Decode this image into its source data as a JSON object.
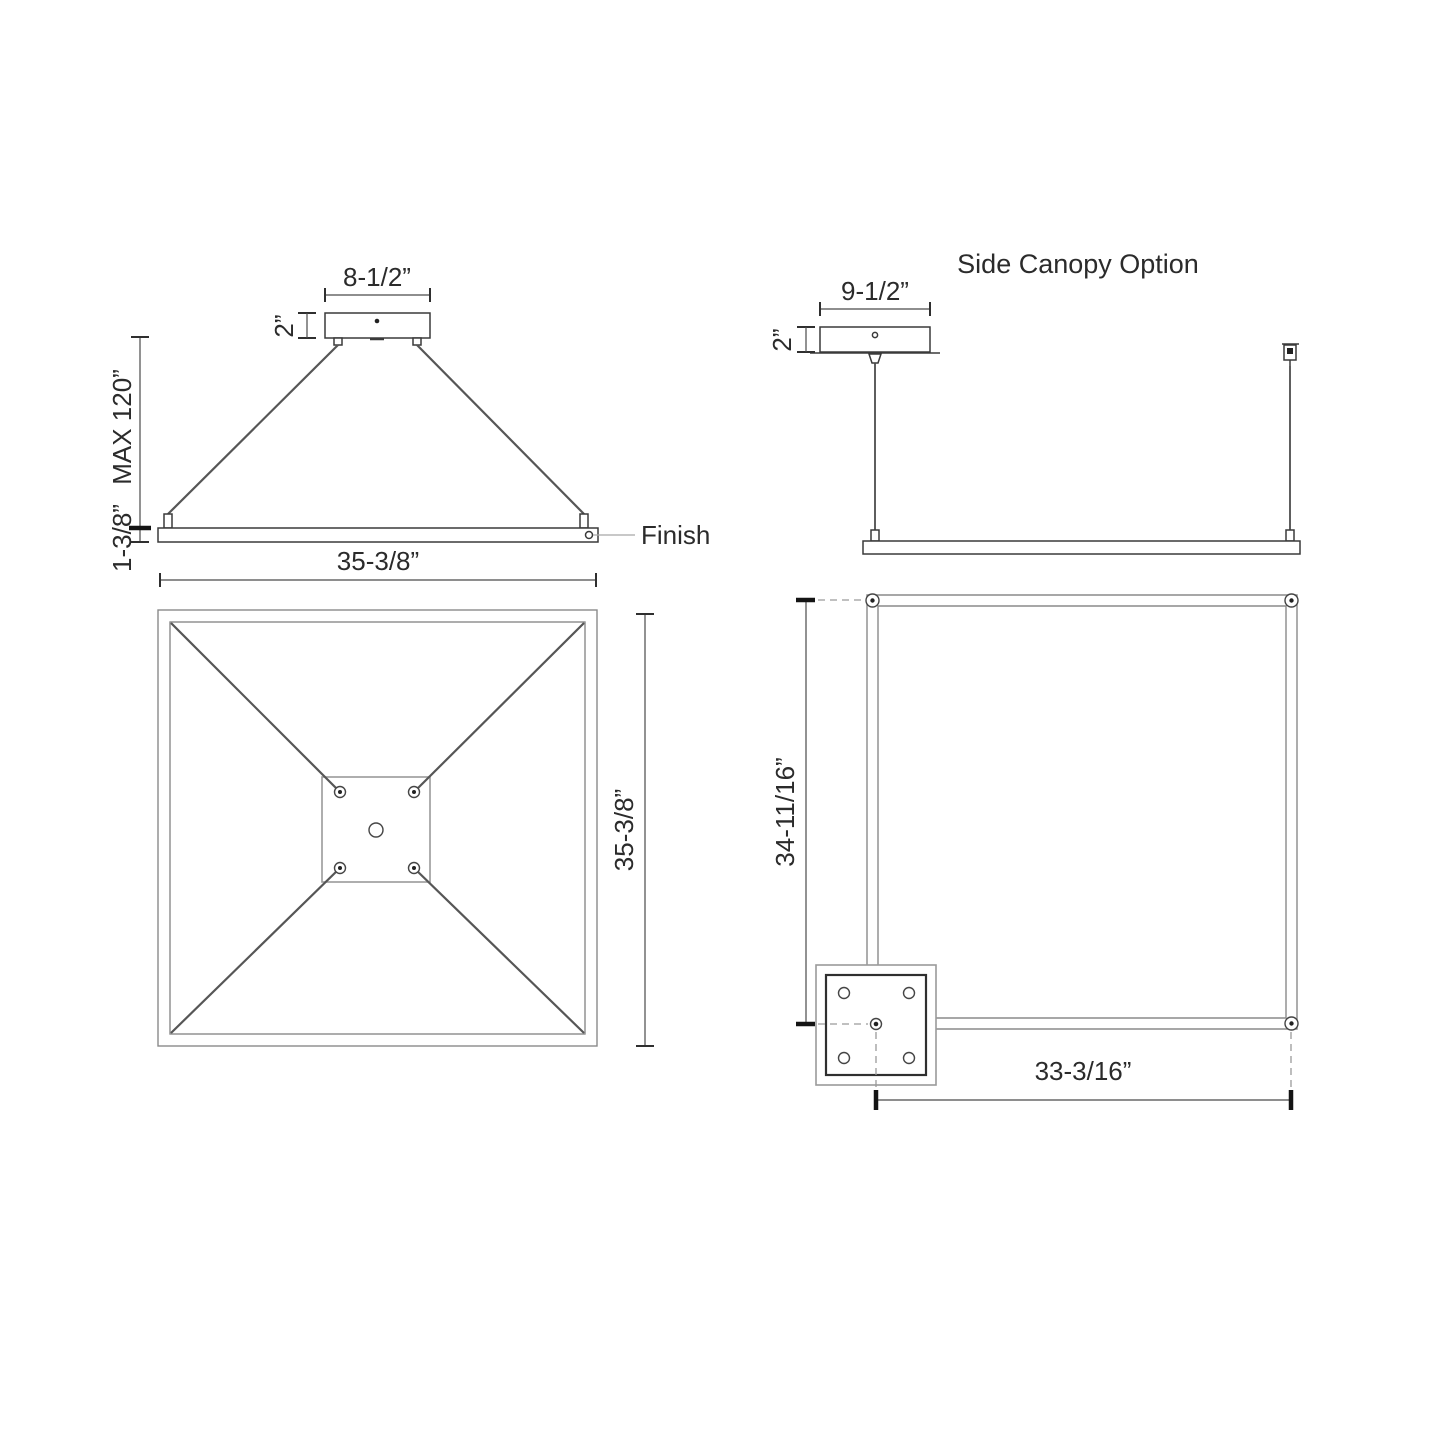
{
  "drawing": {
    "front_view": {
      "canopy_width": "8-1/2”",
      "canopy_height": "2”",
      "max_suspension": "MAX 120”",
      "fixture_thickness": "1-3/8”",
      "fixture_width": "35-3/8”",
      "finish_label": "Finish"
    },
    "side_canopy_front_view": {
      "title": "Side Canopy Option",
      "canopy_width": "9-1/2”",
      "canopy_height": "2”"
    },
    "plan_view": {
      "fixture_depth": "35-3/8”"
    },
    "side_canopy_plan_view": {
      "vertical_to_canopy_center": "34-11/16”",
      "horizontal_to_canopy_center": "33-3/16”"
    },
    "colors": {
      "line_dark": "#3a3a3a",
      "line_medium": "#565656",
      "line_light": "#8a8a8a",
      "text": "#2b2b2b"
    }
  }
}
